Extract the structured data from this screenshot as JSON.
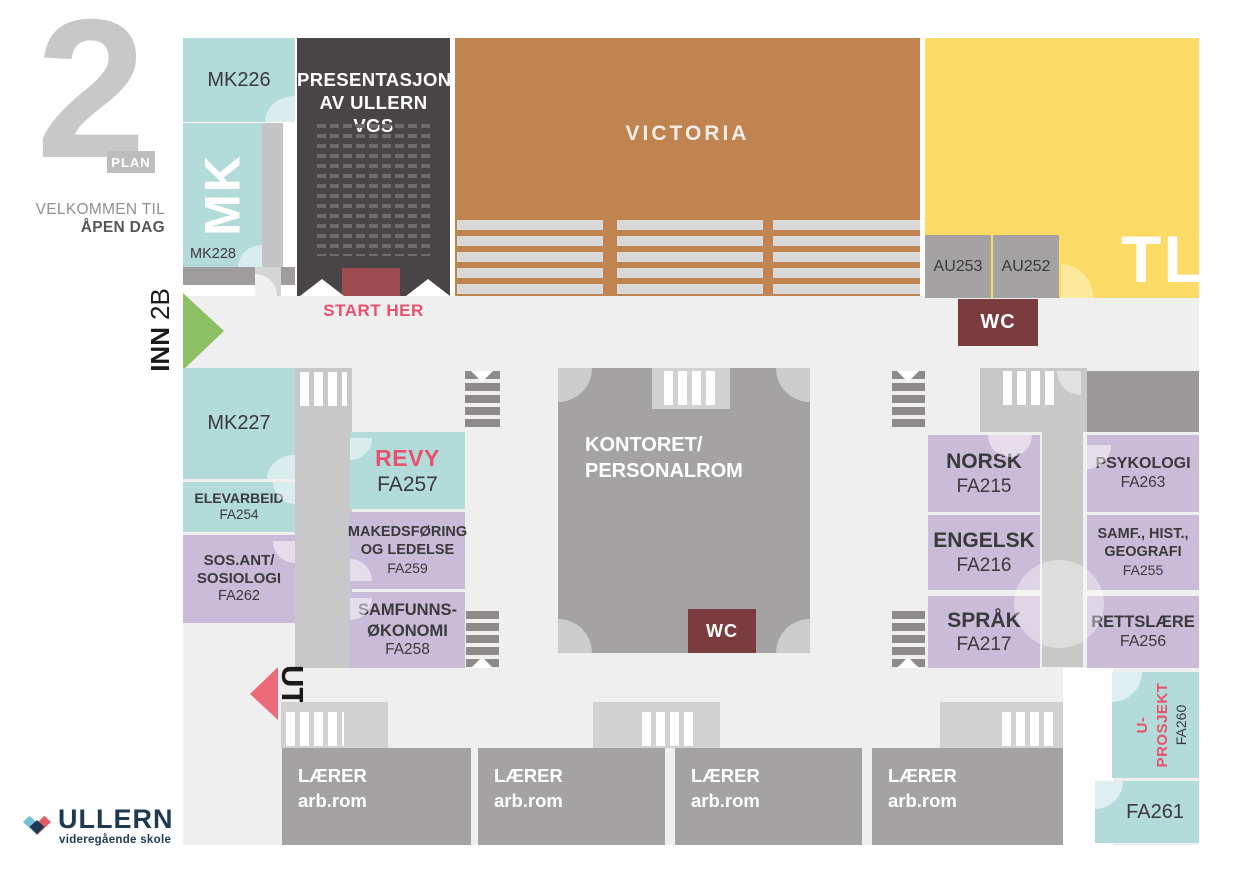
{
  "header": {
    "plan_number": "2",
    "plan_word": "PLAN",
    "welcome_line1": "VELKOMMEN TIL",
    "welcome_line2": "ÅPEN DAG"
  },
  "entrances": {
    "inn_label": "INN",
    "inn_gate": "2B",
    "start_here": "START HER",
    "exit_label": "UT"
  },
  "halls": {
    "mk_label": "MK",
    "presentation_line1": "PRESENTASJON",
    "presentation_line2": "AV ULLERN VGS",
    "victoria": "VICTORIA",
    "tl": "TL",
    "kontoret_line1": "KONTORET/",
    "kontoret_line2": "PERSONALROM",
    "wc_corridor": "WC",
    "wc_kontoret": "WC"
  },
  "rooms": {
    "mk226": "MK226",
    "mk228": "MK228",
    "mk227": "MK227",
    "au253": "AU253",
    "au252": "AU252",
    "elevarbeid_name": "ELEVARBEID",
    "elevarbeid_code": "FA254",
    "sosant_line1": "SOS.ANT/",
    "sosant_line2": "SOSIOLOGI",
    "sosant_code": "FA262",
    "revy_name": "REVY",
    "revy_code": "FA257",
    "marked_line1": "MAKEDSFØRING",
    "marked_line2": "OG LEDELSE",
    "marked_code": "FA259",
    "samok_line1": "SAMFUNNS-",
    "samok_line2": "ØKONOMI",
    "samok_code": "FA258",
    "norsk_name": "NORSK",
    "norsk_code": "FA215",
    "engelsk_name": "ENGELSK",
    "engelsk_code": "FA216",
    "sprak_name": "SPRÅK",
    "sprak_code": "FA217",
    "psykologi_name": "PSYKOLOGI",
    "psykologi_code": "FA263",
    "samf_line1": "SAMF., HIST.,",
    "samf_line2": "GEOGRAFI",
    "samf_code": "FA255",
    "rettslaere_name": "RETTSLÆRE",
    "rettslaere_code": "FA256",
    "uprosjekt_name": "U-PROSJEKT",
    "uprosjekt_code": "FA260",
    "fa261": "FA261",
    "laerer_name": "LÆRER",
    "laerer_sub": "arb.rom"
  },
  "logo": {
    "school_name": "ULLERN",
    "school_subtitle": "videregående skole"
  },
  "colors": {
    "teal": "#b3dbd9",
    "purple": "#cabbd9",
    "room_gray": "#a5a2a3",
    "corridor_gray": "#c9c8c8",
    "background_gray": "#efeff0",
    "dark_hall": "#494547",
    "victoria_brown": "#c08450",
    "tl_yellow": "#fbdb66",
    "wc_maroon": "#7b3c3f",
    "stage_red": "#9e4b50",
    "entrance_green": "#8cc063",
    "accent_pink": "#e8516d",
    "exit_red": "#ed6a79",
    "logo_navy": "#1e3a52"
  }
}
